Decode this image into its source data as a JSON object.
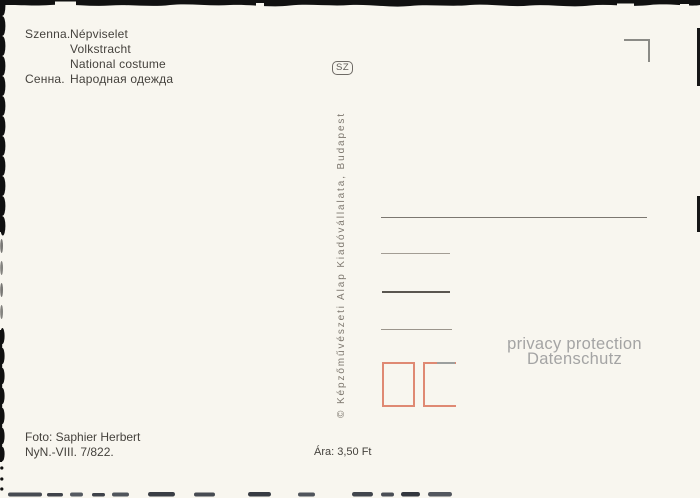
{
  "caption": {
    "rows": [
      {
        "label": "Szenna.",
        "text": "Népviselet"
      },
      {
        "label": "",
        "text": "Volkstracht"
      },
      {
        "label": "",
        "text": "National costume"
      },
      {
        "label": "Сенна.",
        "text": "Народная одежда"
      }
    ]
  },
  "badge": {
    "text": "SZ"
  },
  "publisher": {
    "text": "© Képzőművészeti Alap Kiadóvállalata, Budapest"
  },
  "watermark": {
    "line1": "privacy protection",
    "line2": "Datenschutz"
  },
  "footer": {
    "photo_credit": "Foto: Saphier Herbert",
    "catalog_number": "NyN.-VIII. 7/822.",
    "price": "Ára: 3,50 Ft"
  },
  "colors": {
    "paper": "#f8f6ef",
    "ink": "#45423d",
    "stamp_box_accent": "#df8973",
    "watermark_gray": "#a4a4a4",
    "scan_edge_black": "#111111"
  }
}
